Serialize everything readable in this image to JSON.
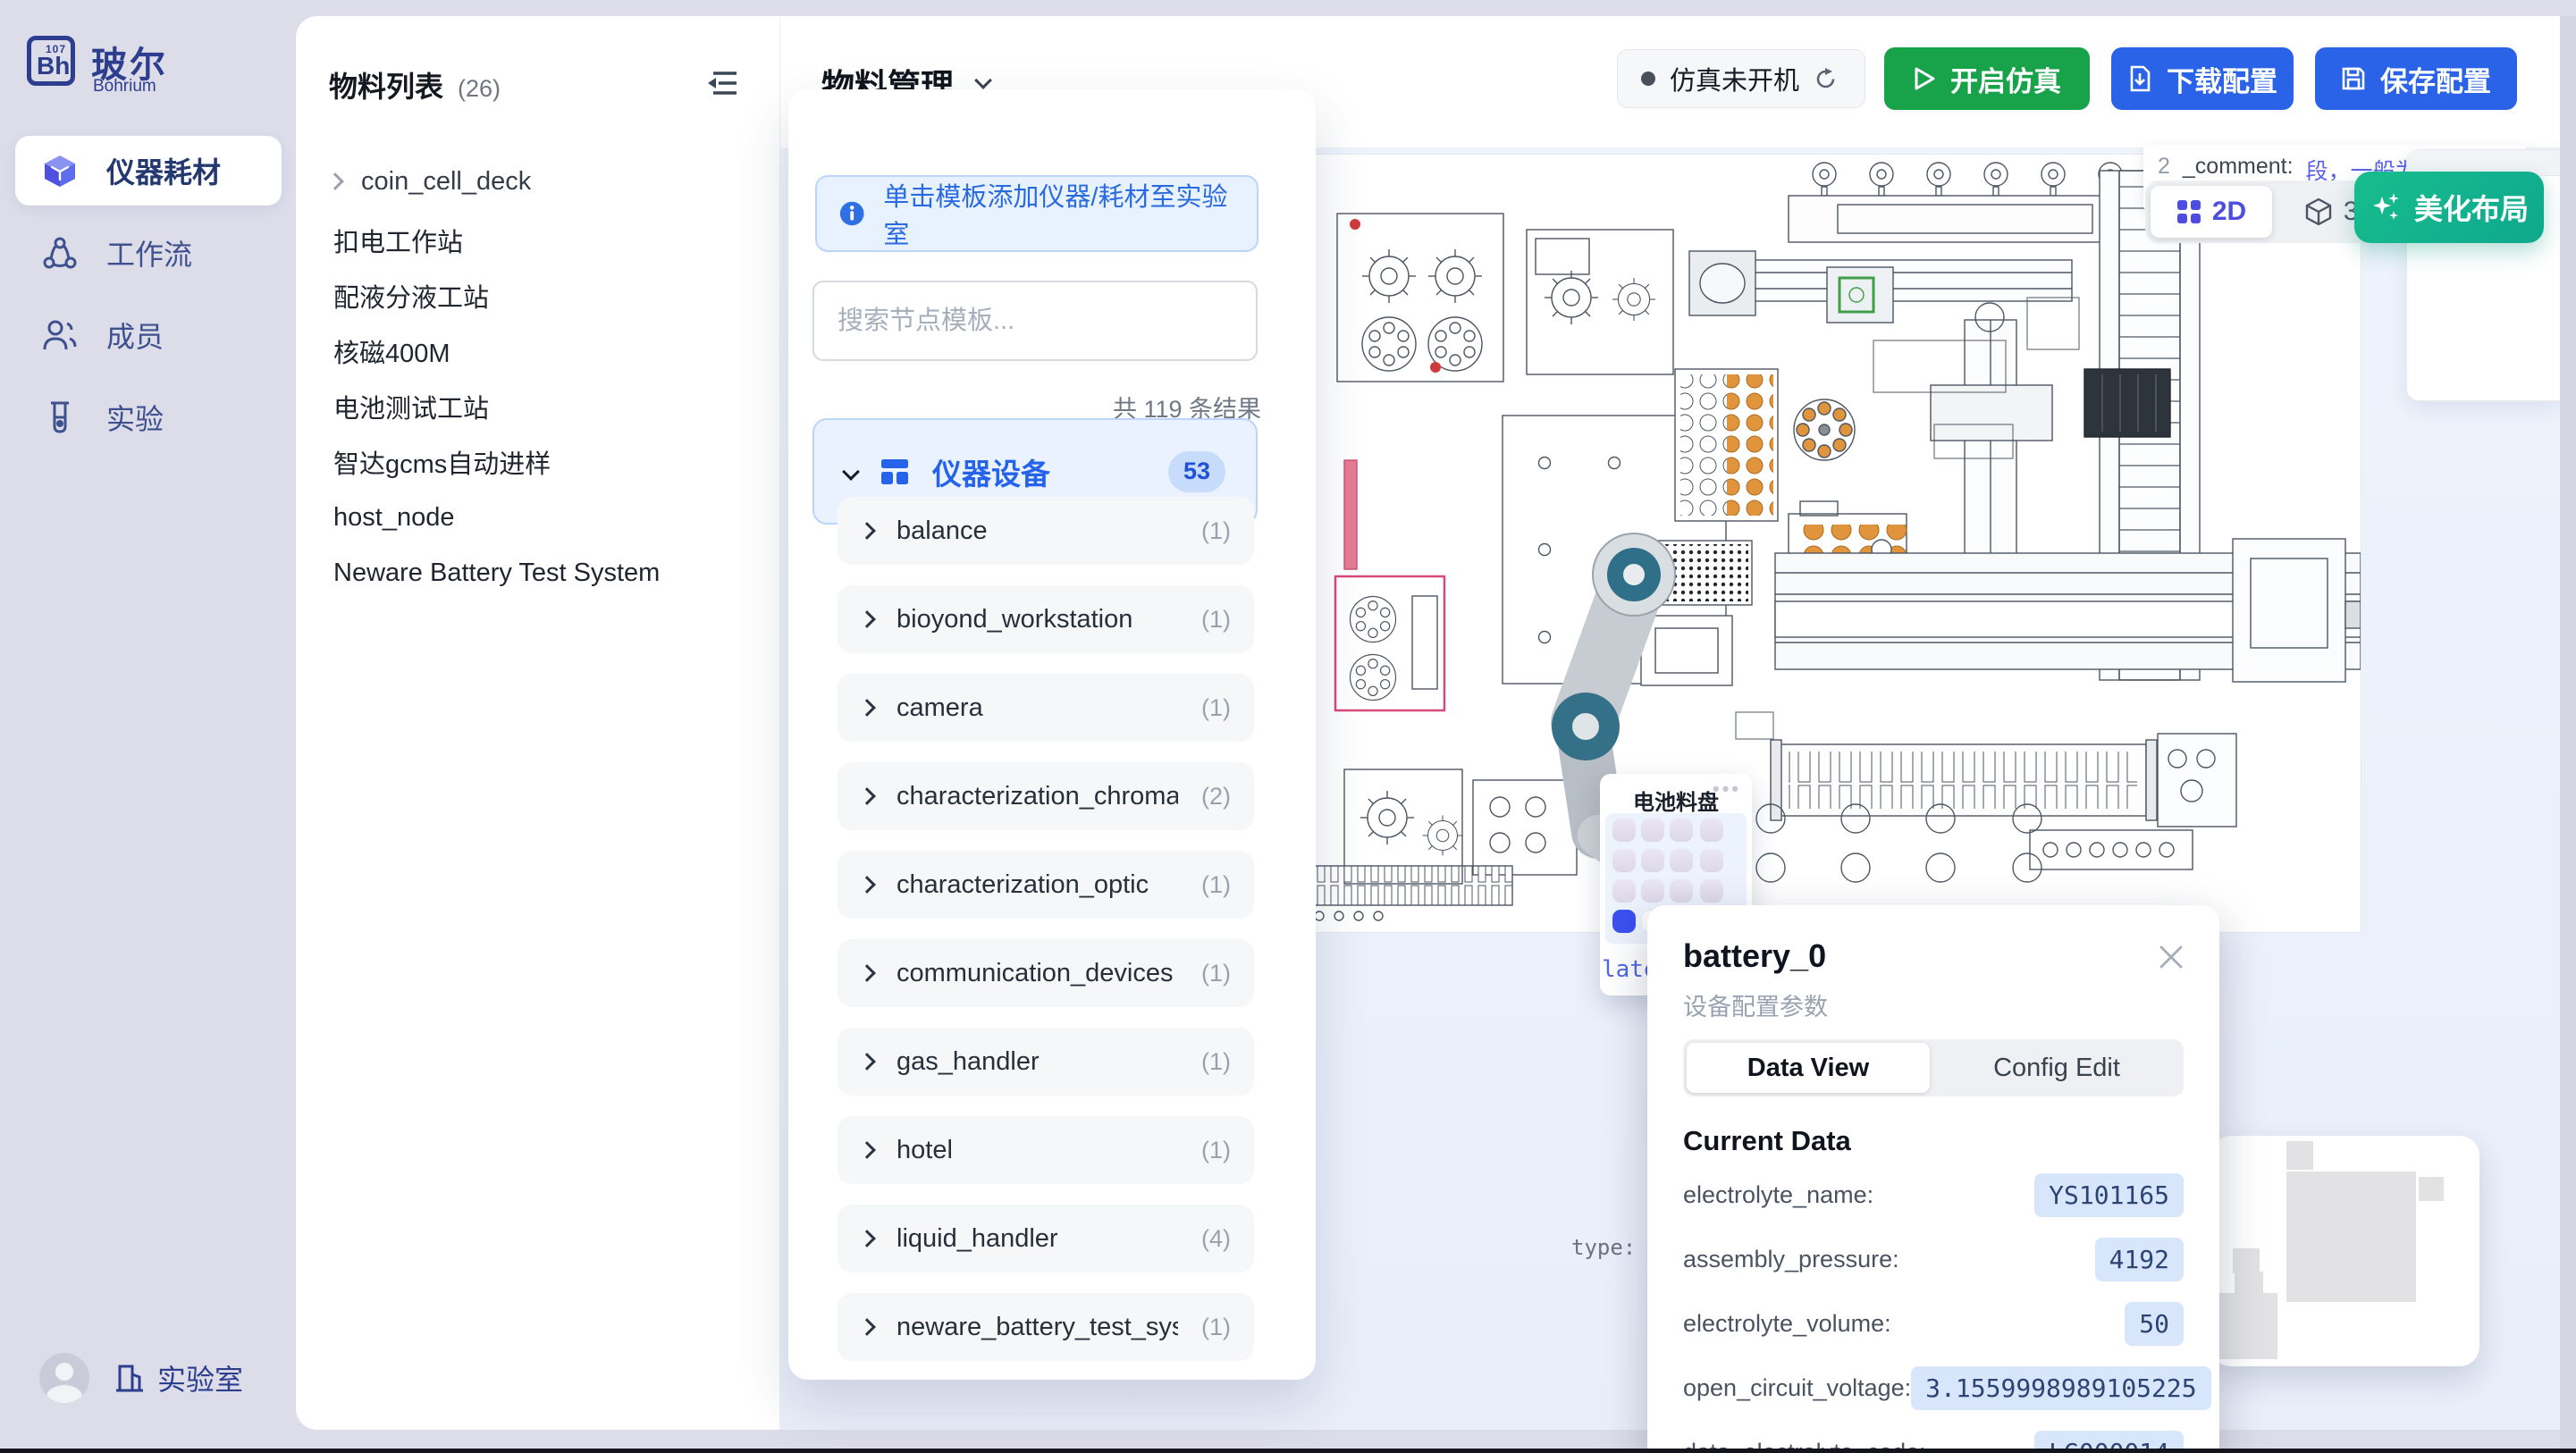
{
  "app": {
    "logo_element": "Bh",
    "logo_number": "107",
    "brand": "玻尔",
    "brand_sub": "Bohrium"
  },
  "sidebar": {
    "items": [
      {
        "label": "仪器耗材"
      },
      {
        "label": "工作流"
      },
      {
        "label": "成员"
      },
      {
        "label": "实验"
      }
    ],
    "footer_label": "实验室"
  },
  "materials": {
    "title": "物料列表",
    "count": "(26)",
    "tree_item": "coin_cell_deck",
    "items": [
      "扣电工作站",
      "配液分液工站",
      "核磁400M",
      "电池测试工站",
      "智达gcms自动进样",
      "host_node",
      "Neware Battery Test System"
    ]
  },
  "header": {
    "title": "物料管理",
    "status_label": "仿真未开机",
    "start_label": "开启仿真",
    "download_label": "下载配置",
    "save_label": "保存配置"
  },
  "template_panel": {
    "banner": "单击模板添加仪器/耗材至实验室",
    "search_placeholder": "搜索节点模板...",
    "result_count": "共 119 条结果",
    "category_label": "仪器设备",
    "category_badge": "53",
    "items": [
      {
        "label": "balance",
        "count": "(1)"
      },
      {
        "label": "bioyond_workstation",
        "count": "(1)"
      },
      {
        "label": "camera",
        "count": "(1)"
      },
      {
        "label": "characterization_chromatic",
        "count": "(2)"
      },
      {
        "label": "characterization_optic",
        "count": "(1)"
      },
      {
        "label": "communication_devices",
        "count": "(1)"
      },
      {
        "label": "gas_handler",
        "count": "(1)"
      },
      {
        "label": "hotel",
        "count": "(1)"
      },
      {
        "label": "liquid_handler",
        "count": "(4)"
      },
      {
        "label": "neware_battery_test_system",
        "count": "(1)"
      }
    ]
  },
  "canvas": {
    "comment_prefix": "2",
    "comment_key": "_comment:",
    "comment_value": "段，一般为空，stat",
    "comment_value2": "此固定",
    "toggle_2d": "2D",
    "toggle_3d": "3D",
    "beautify_label": "美化布局",
    "partial_panel_text": "esou",
    "type_key": "type:",
    "type_value": "Coi",
    "tray_title": "电池料盘",
    "tray_menu": "•••",
    "tray_footer_partial": "late"
  },
  "battery_popup": {
    "title": "battery_0",
    "subtitle": "设备配置参数",
    "tab_data_view": "Data View",
    "tab_config_edit": "Config Edit",
    "section_title": "Current Data",
    "rows": [
      {
        "key": "electrolyte_name:",
        "value": "YS101165"
      },
      {
        "key": "assembly_pressure:",
        "value": "4192"
      },
      {
        "key": "electrolyte_volume:",
        "value": "50"
      },
      {
        "key": "open_circuit_voltage:",
        "value": "3.1559998989105225"
      },
      {
        "key": "data_electrolyte_code:",
        "value": "LG000014"
      }
    ]
  },
  "colors": {
    "accent_blue": "#2563eb",
    "green": "#18a249",
    "teal": "#12b487",
    "indigo": "#4f4ce0",
    "sidebar_bg": "#dcdde9",
    "canvas_blue": "#ecf1fb",
    "value_pill_bg": "#d8e6fc"
  }
}
